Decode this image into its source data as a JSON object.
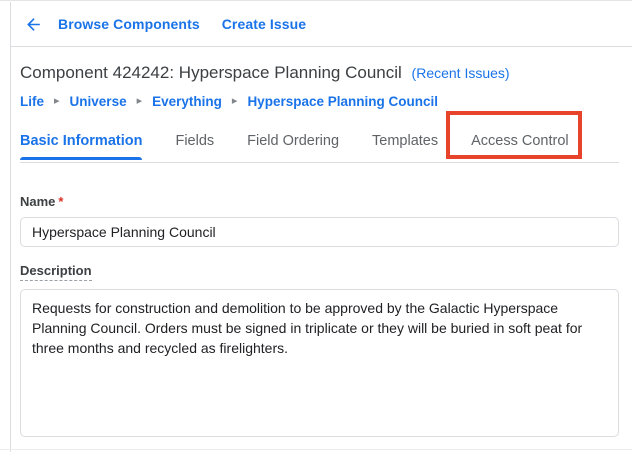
{
  "topbar": {
    "links": [
      {
        "label": "Browse Components"
      },
      {
        "label": "Create Issue"
      }
    ]
  },
  "header": {
    "title": "Component 424242: Hyperspace Planning Council",
    "recent_issues_link": "(Recent Issues)"
  },
  "breadcrumb": {
    "separator": "▸",
    "items": [
      {
        "label": "Life"
      },
      {
        "label": "Universe"
      },
      {
        "label": "Everything"
      },
      {
        "label": "Hyperspace Planning Council"
      }
    ]
  },
  "tabs": {
    "items": [
      {
        "label": "Basic Information",
        "active": true,
        "annotated": false
      },
      {
        "label": "Fields",
        "active": false,
        "annotated": false
      },
      {
        "label": "Field Ordering",
        "active": false,
        "annotated": false
      },
      {
        "label": "Templates",
        "active": false,
        "annotated": false
      },
      {
        "label": "Access Control",
        "active": false,
        "annotated": true
      }
    ]
  },
  "form": {
    "name_label": "Name",
    "required_marker": "*",
    "name_value": "Hyperspace Planning Council",
    "description_label": "Description",
    "description_value": "Requests for construction and demolition to be approved by the Galactic Hyperspace Planning Council. Orders must be signed in triplicate or they will be buried in soft peat for three months and recycled as firelighters."
  },
  "colors": {
    "accent_blue": "#1a73e8",
    "annotation_red": "#e8432b",
    "required_red": "#d93025",
    "border_gray": "#dadce0",
    "tab_inactive": "#5f6368"
  }
}
